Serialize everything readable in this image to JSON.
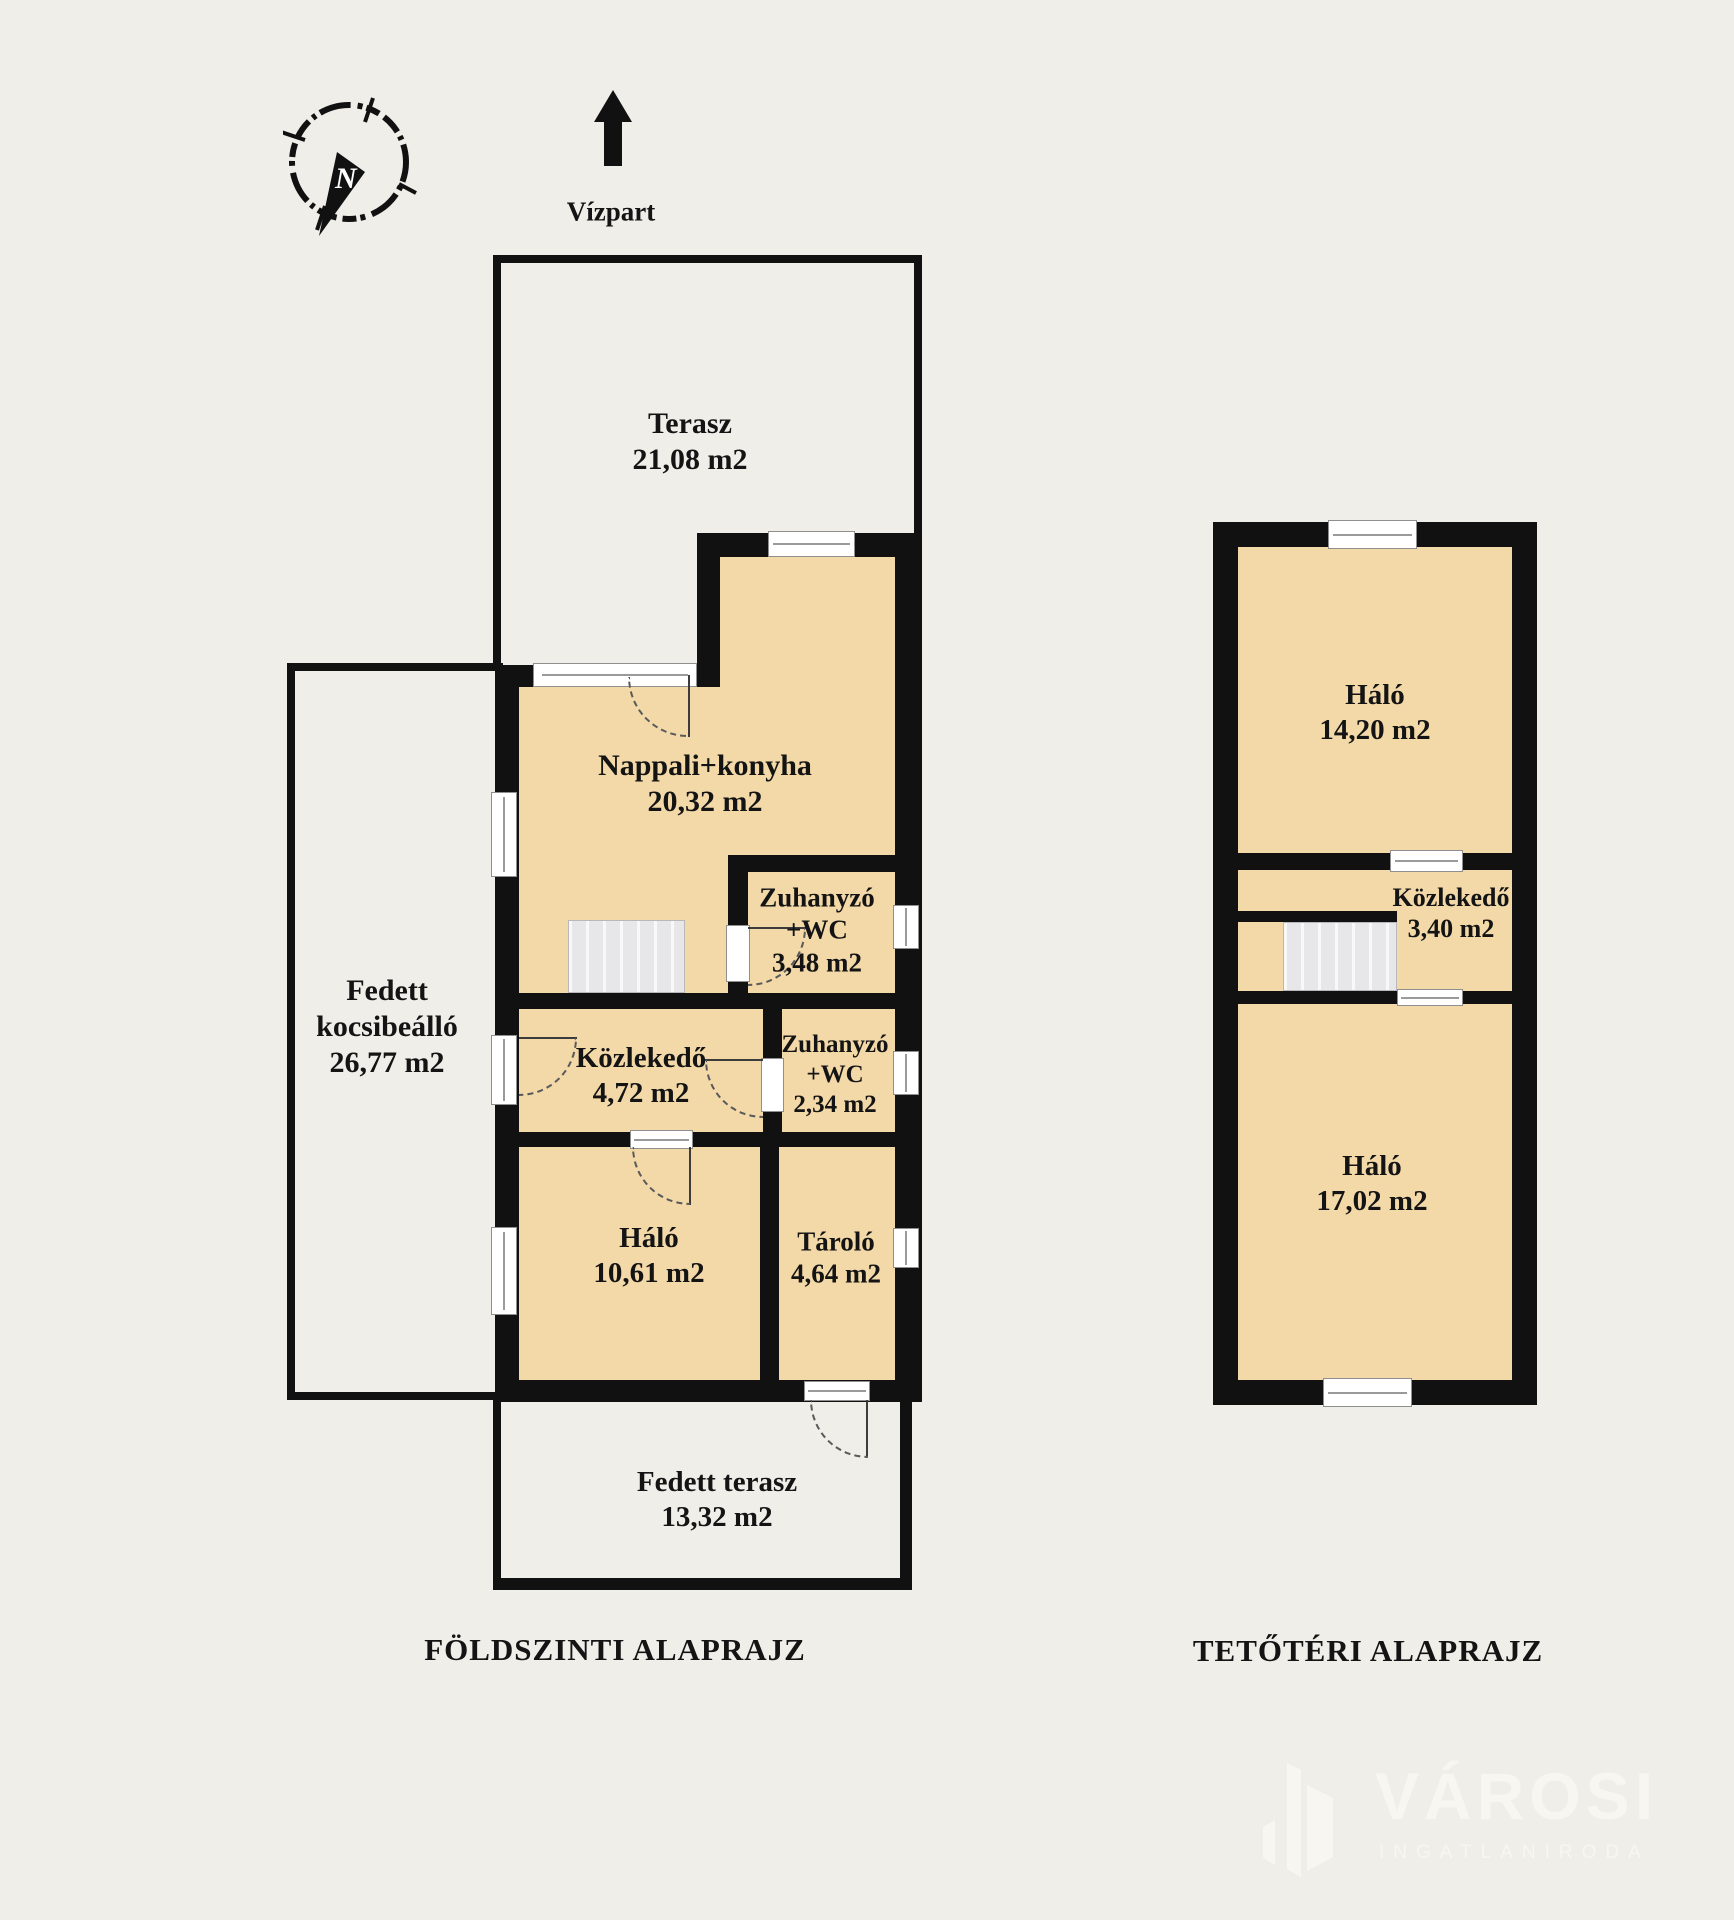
{
  "compass": {
    "label": "N"
  },
  "orientation": {
    "label": "Vízpart"
  },
  "ground_floor": {
    "title": "FÖLDSZINTI ALAPRAJZ",
    "rooms": [
      {
        "name": "Terasz",
        "area": "21,08 m2"
      },
      {
        "name": "Nappali+konyha",
        "area": "20,32 m2"
      },
      {
        "name": "Zuhanyzó +WC",
        "area": "3,48 m2"
      },
      {
        "name": "Közlekedő",
        "area": "4,72 m2"
      },
      {
        "name": "Zuhanyzó +WC",
        "area": "2,34 m2"
      },
      {
        "name": "Háló",
        "area": "10,61 m2"
      },
      {
        "name": "Tároló",
        "area": "4,64 m2"
      },
      {
        "name": "Fedett kocsibeálló",
        "area": "26,77 m2"
      },
      {
        "name": "Fedett terasz",
        "area": "13,32 m2"
      }
    ]
  },
  "attic": {
    "title": "TETŐTÉRI ALAPRAJZ",
    "rooms": [
      {
        "name": "Háló",
        "area": "14,20 m2"
      },
      {
        "name": "Közlekedő",
        "area": "3,40 m2"
      },
      {
        "name": "Háló",
        "area": "17,02 m2"
      }
    ]
  },
  "branding": {
    "name": "VÁROSI",
    "tagline": "INGATLANIRODA"
  },
  "colors": {
    "wall": "#111111",
    "room_fill": "#f3d9a8",
    "background": "#f0eee9",
    "frame": "#8f8f8f"
  }
}
